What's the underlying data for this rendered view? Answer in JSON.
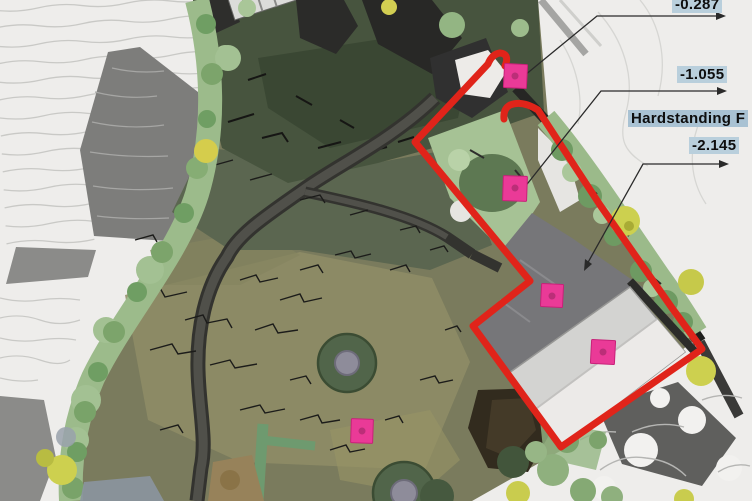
{
  "plan": {
    "type": "landscape site plan",
    "annotations": [
      {
        "id": "level-top",
        "text": "-0.287"
      },
      {
        "id": "level-mid",
        "text": "-1.055"
      },
      {
        "id": "hardstanding",
        "text": "Hardstanding F"
      },
      {
        "id": "level-hardstanding",
        "text": "-2.145"
      }
    ],
    "markers": {
      "count": 5
    },
    "colors": {
      "boundary": "#e0241a",
      "marker": "#ea3a97",
      "marker_border": "#c82179",
      "annotation_bg": "#b9cfdc",
      "annotation_bg_strong": "#a9c2d3",
      "annotation_text": "#0e0e0e"
    }
  }
}
